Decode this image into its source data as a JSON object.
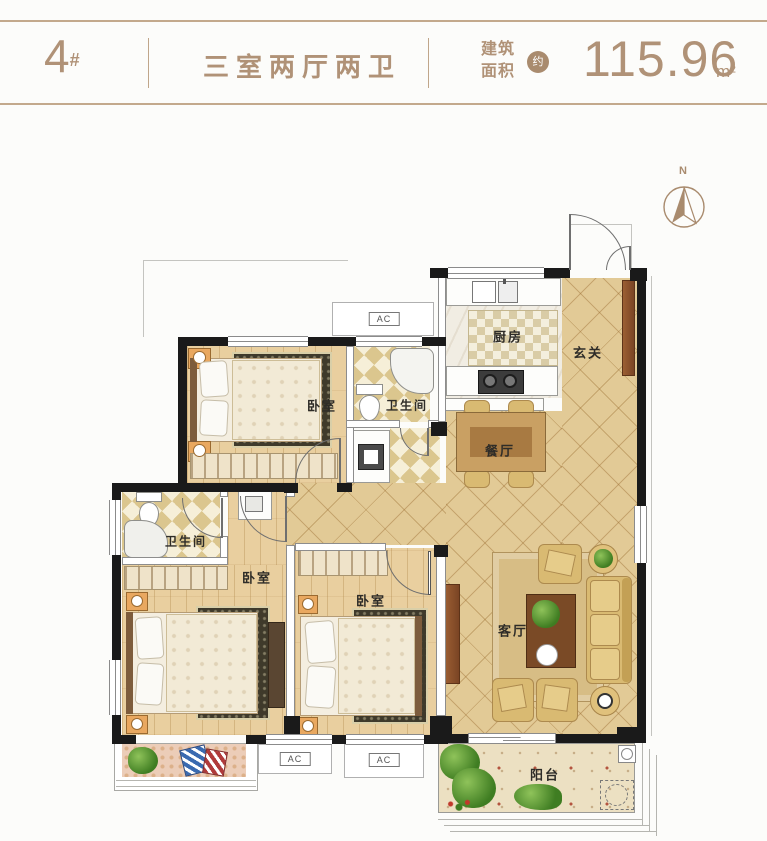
{
  "header": {
    "building_number": "4",
    "building_number_suffix": "#",
    "layout_type": "三室两厅两卫",
    "area_label_line1": "建筑",
    "area_label_line2": "面积",
    "area_approx_badge": "约",
    "area_value": "115.96",
    "area_unit": "m²"
  },
  "compass": {
    "north": "N"
  },
  "rooms": {
    "bedroom_top": "卧室",
    "bathroom_top": "卫生间",
    "kitchen": "厨房",
    "entry": "玄关",
    "dining": "餐厅",
    "bathroom_left": "卫生间",
    "bedroom_left": "卧室",
    "bedroom_middle": "卧室",
    "living_room": "客厅",
    "balcony": "阳台"
  },
  "annotations": {
    "ac_top": "AC",
    "ac_bottom_left": "AC",
    "ac_bottom_right": "AC"
  },
  "colors": {
    "accent": "#b09277",
    "wall": "#1a1a1a",
    "tile_floor": "#e2ca96",
    "wood_floor": "#e9cf9f",
    "bath_tile": "#dbc68e",
    "label_text": "#2e2c28"
  }
}
